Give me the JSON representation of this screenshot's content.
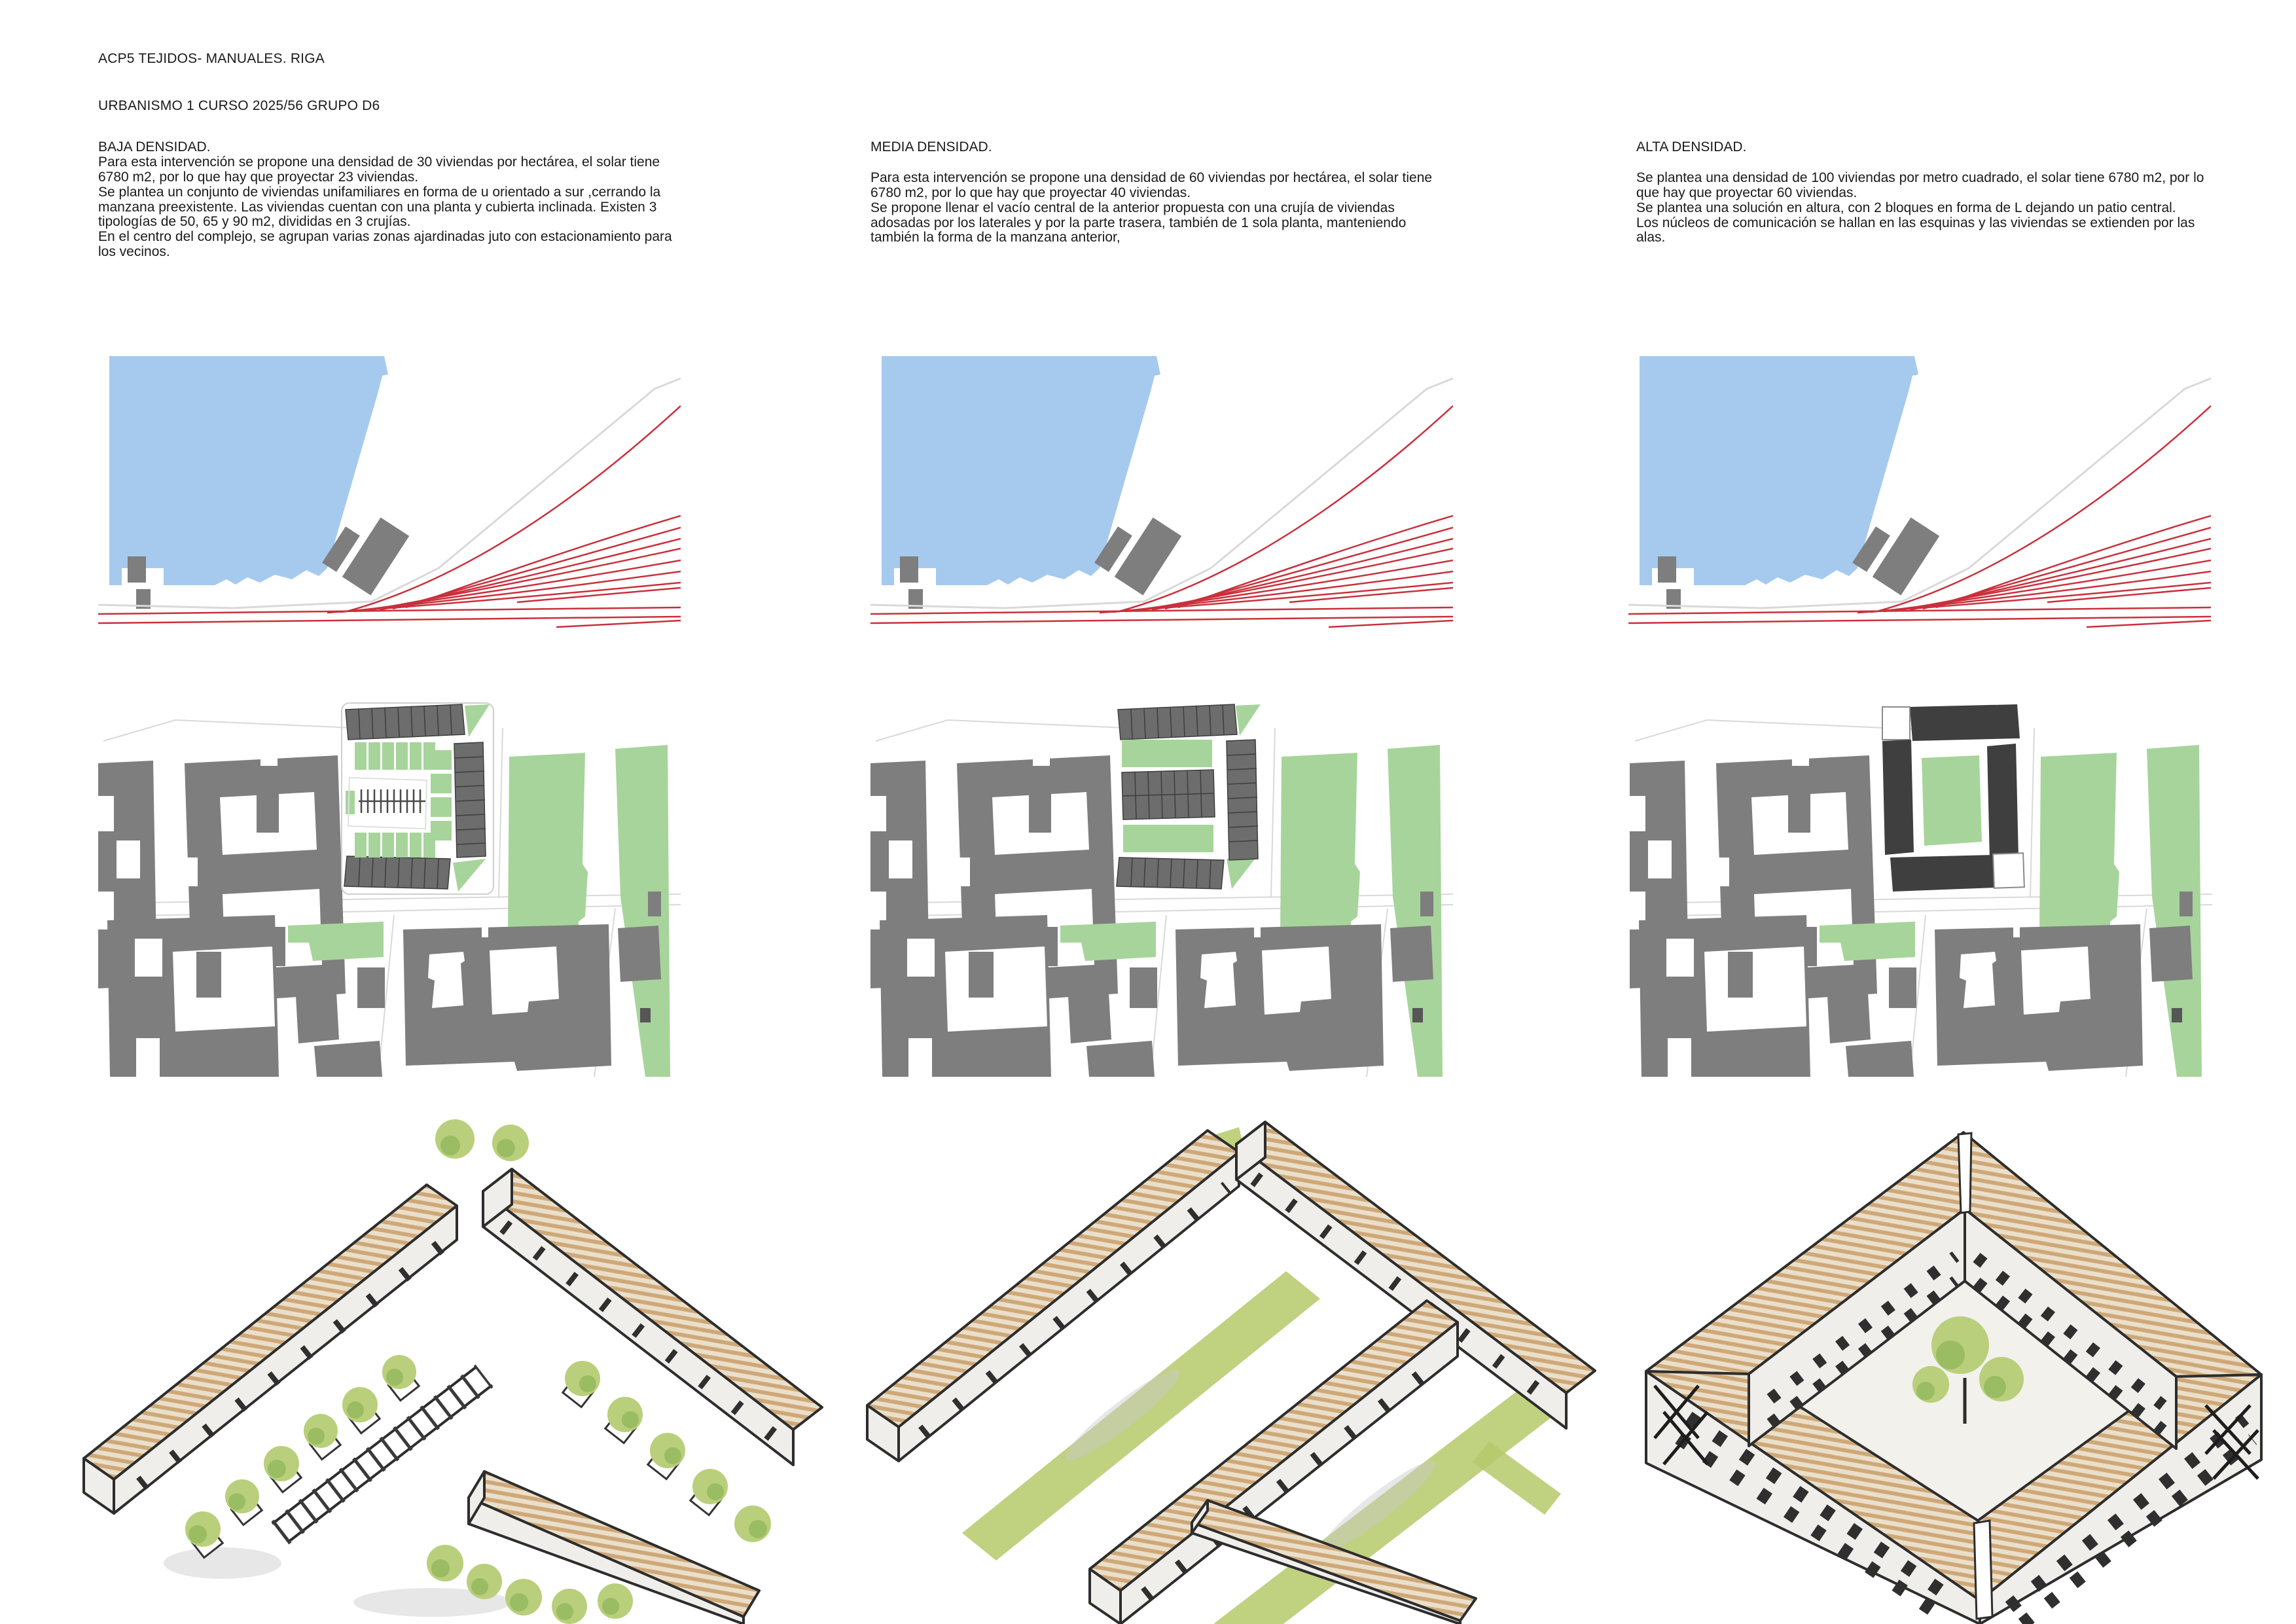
{
  "page": {
    "title_line1": "ACP5 TEJIDOS- MANUALES. RIGA",
    "title_line2": "URBANISMO 1 CURSO 2025/56 GRUPO D6"
  },
  "sections": [
    {
      "heading": "BAJA DENSIDAD.",
      "paragraphs": [
        "Para esta intervención se propone una densidad de 30 viviendas por hectárea, el solar tiene 6780 m2, por lo que hay que proyectar 23 viviendas.",
        "Se plantea un conjunto de viviendas unifamiliares en forma de u orientado a sur ,cerrando la manzana preexistente. Las viviendas cuentan con una planta y cubierta inclinada. Existen 3 tipologías de 50, 65 y 90 m2, divididas en 3 crujías.",
        "En el centro del complejo, se agrupan varias zonas ajardinadas juto con estacionamiento para los vecinos."
      ]
    },
    {
      "heading": "MEDIA DENSIDAD.",
      "paragraphs": [
        "Para esta intervención se propone una densidad de 60 viviendas por hectárea, el solar tiene 6780 m2, por lo que hay que proyectar 40 viviendas.",
        "Se propone llenar el vacío central de la anterior propuesta con una crujía de viviendas adosadas por los laterales y por la parte trasera, también de 1 sola planta, manteniendo también la forma de la manzana anterior,"
      ]
    },
    {
      "heading": "ALTA DENSIDAD.",
      "paragraphs": [
        "Se plantea una densidad de 100 viviendas por metro cuadrado, el solar tiene 6780 m2, por lo que hay que proyectar 60 viviendas.",
        "Se plantea una solución en altura, con 2 bloques en forma de L dejando un patio central.",
        "Los núcleos de comunicación se hallan en las esquinas y las viviendas se extienden por las alas."
      ]
    }
  ],
  "colors": {
    "water": "#a5caee",
    "rail": "#c9303c",
    "road": "#d9d9d9",
    "context_gray": "#7e7e7e",
    "unit_gray": "#6d6d6d",
    "unit_outline": "#3e3e3e",
    "dark_block": "#3f3f3f",
    "park_green": "#a7d49b",
    "sketch_line": "#2d2d2d",
    "roof_tan": "#cfa878",
    "roof_base": "#eadfca",
    "wall": "#efeeea",
    "tree_green": "#b9cf7b",
    "tree_dark": "#94b85e",
    "strip_green": "#b5c96a"
  }
}
